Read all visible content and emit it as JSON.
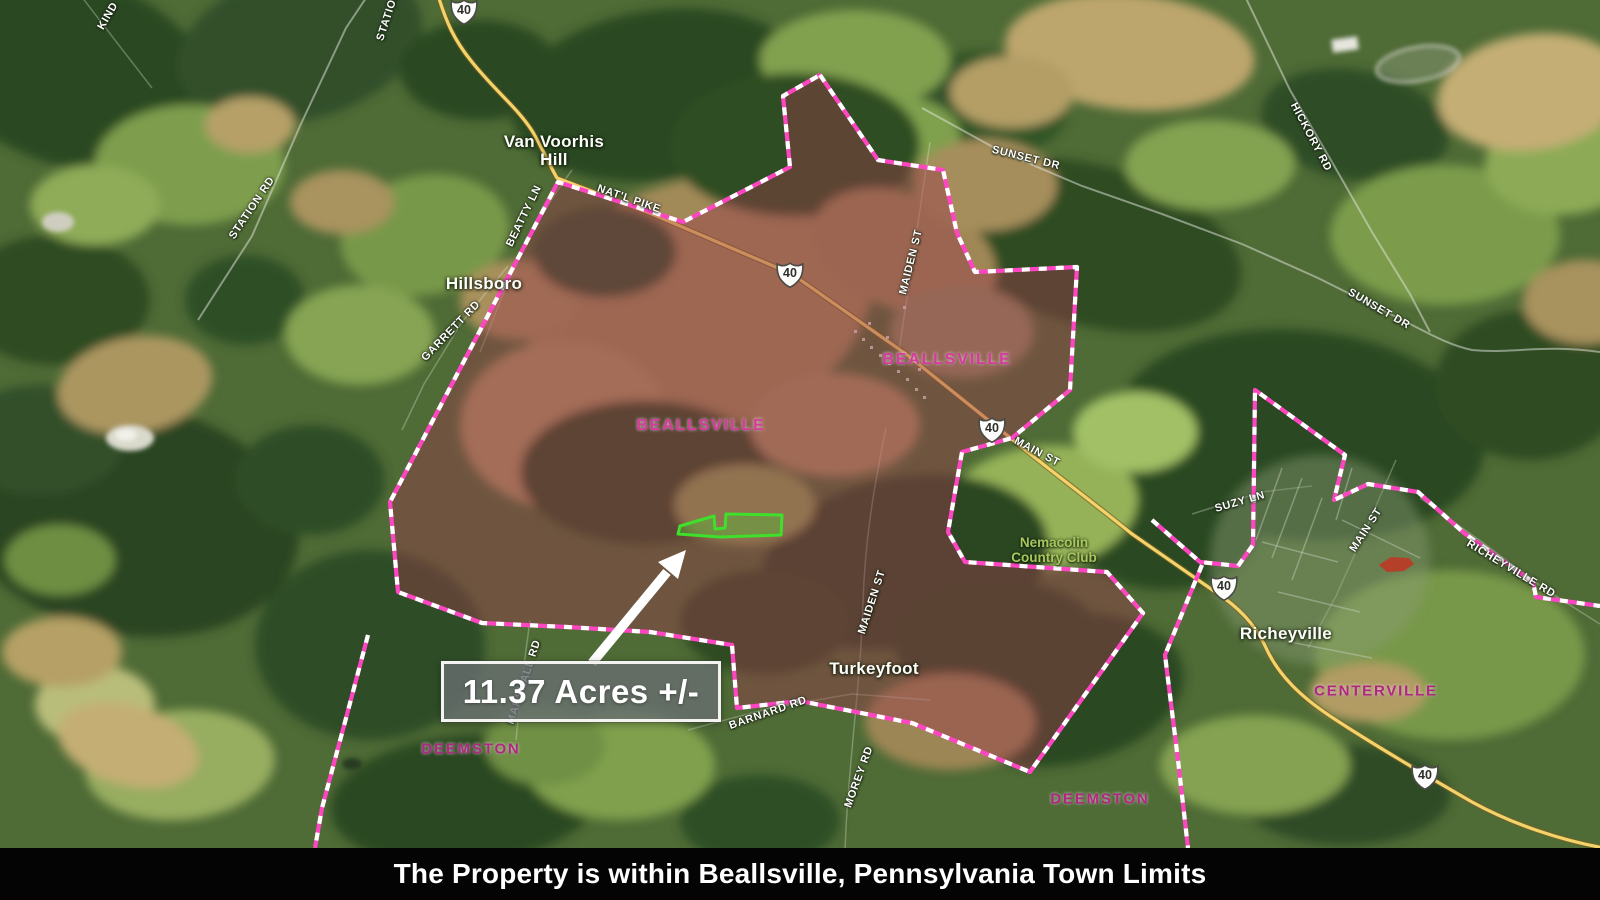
{
  "caption_bar": {
    "text": "The Property is within Beallsville, Pennsylvania Town Limits"
  },
  "callout": {
    "text": "11.37 Acres +/-"
  },
  "route_shield": {
    "number": "40"
  },
  "shields": [
    {
      "x": 464,
      "y": 12
    },
    {
      "x": 790,
      "y": 275
    },
    {
      "x": 992,
      "y": 430
    },
    {
      "x": 1224,
      "y": 588
    },
    {
      "x": 1425,
      "y": 777
    }
  ],
  "labels": {
    "places": [
      {
        "lines": [
          "Van Voorhis",
          "Hill"
        ],
        "x": 554,
        "y": 151
      },
      {
        "lines": [
          "Hillsboro"
        ],
        "x": 484,
        "y": 284
      },
      {
        "lines": [
          "Turkeyfoot"
        ],
        "x": 874,
        "y": 669
      },
      {
        "lines": [
          "Richeyville"
        ],
        "x": 1286,
        "y": 634
      }
    ],
    "towns": [
      {
        "text": "BEALLSVILLE",
        "x": 947,
        "y": 360,
        "bright": true
      },
      {
        "text": "BEALLSVILLE",
        "x": 701,
        "y": 426,
        "bright": true
      },
      {
        "text": "CENTERVILLE",
        "x": 1376,
        "y": 691,
        "bright": false
      },
      {
        "text": "DEEMSTON",
        "x": 471,
        "y": 749,
        "bright": false
      },
      {
        "text": "DEEMSTON",
        "x": 1100,
        "y": 799,
        "bright": false
      }
    ],
    "roads": [
      {
        "text": "KIND",
        "x": 108,
        "y": 16,
        "rot": -60
      },
      {
        "text": "STATION",
        "x": 388,
        "y": 16,
        "rot": -72
      },
      {
        "text": "STATION RD",
        "x": 252,
        "y": 208,
        "rot": -56
      },
      {
        "text": "BEATTY LN",
        "x": 524,
        "y": 216,
        "rot": -64
      },
      {
        "text": "NAT'L PIKE",
        "x": 629,
        "y": 199,
        "rot": 19
      },
      {
        "text": "GARRETT RD",
        "x": 451,
        "y": 331,
        "rot": -46
      },
      {
        "text": "MAIDEN ST",
        "x": 911,
        "y": 262,
        "rot": -76
      },
      {
        "text": "SUNSET DR",
        "x": 1026,
        "y": 158,
        "rot": 14
      },
      {
        "text": "HICKORY RD",
        "x": 1311,
        "y": 137,
        "rot": 62
      },
      {
        "text": "SUNSET DR",
        "x": 1379,
        "y": 309,
        "rot": 30
      },
      {
        "text": "MAIN ST",
        "x": 1037,
        "y": 452,
        "rot": 28
      },
      {
        "text": "SUZY LN",
        "x": 1240,
        "y": 502,
        "rot": -16
      },
      {
        "text": "MAIN ST",
        "x": 1366,
        "y": 530,
        "rot": -57
      },
      {
        "text": "RICHEYVILLE RD",
        "x": 1511,
        "y": 569,
        "rot": 31
      },
      {
        "text": "MAIDEN ST",
        "x": 872,
        "y": 602,
        "rot": -72
      },
      {
        "text": "MARSHALL RD",
        "x": 524,
        "y": 682,
        "rot": -72
      },
      {
        "text": "BARNARD RD",
        "x": 768,
        "y": 713,
        "rot": -19
      },
      {
        "text": "MOREY RD",
        "x": 859,
        "y": 777,
        "rot": -70
      }
    ],
    "park": {
      "lines": [
        "Nemacolin",
        "Country Club"
      ],
      "x": 1054,
      "y": 551
    }
  },
  "colors": {
    "boundary_pink": "#ff46c2",
    "overlay_fill": "rgba(150,60,75,0.45)",
    "town_bright": "#d63a9b",
    "town_dark": "#b1267f",
    "park_green": "#a8c85e",
    "parcel_green": "#3fe02c",
    "parcel_fill": "rgba(70,195,50,0.38)",
    "red_parcel": "#c23524",
    "road_yellow": "#f4d36b"
  }
}
